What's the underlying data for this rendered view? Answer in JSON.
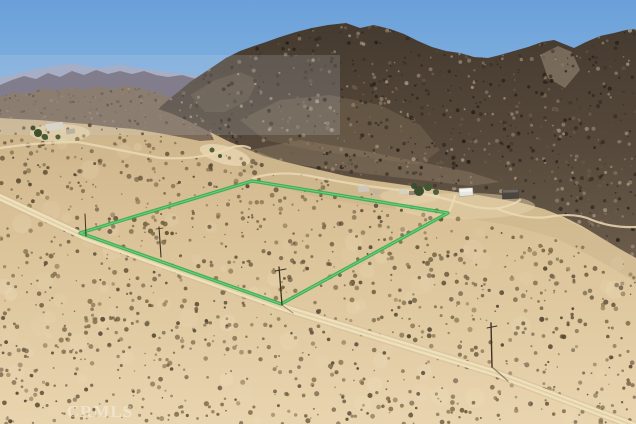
{
  "photo": {
    "watermark": "CRMLS",
    "parcel": {
      "outline_points": "252,181 448,213 281,304 80,233",
      "outline_color": "#35ad4f",
      "outline_highlight_color": "#86dd98"
    },
    "colors": {
      "sky_top": "#69a0d9",
      "sky_bottom": "#bdd6ee",
      "sand_dark": "#cdb48c",
      "sand_light": "#e8d4ae",
      "mountain_dark": "#4e4336",
      "road": "#efe0bc"
    }
  }
}
